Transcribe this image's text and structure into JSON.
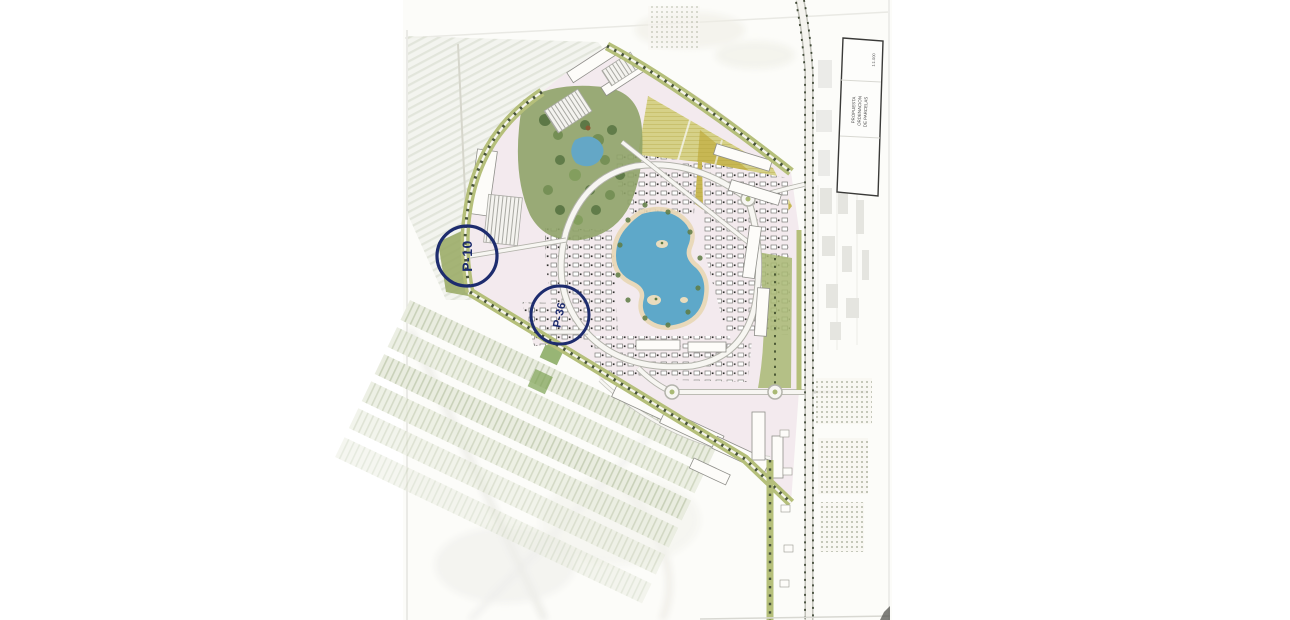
{
  "paper": {
    "tone": "#fcfcf9"
  },
  "annotations": {
    "color": "#1d2c6e",
    "circles": [
      {
        "label": "P-10"
      },
      {
        "label": "P-36"
      }
    ]
  },
  "title_block": {
    "line1": "PROPUESTA",
    "line2": "ORDENACION",
    "line3": "DE PARCELAS",
    "scale": "1:1.000"
  },
  "colors": {
    "lake": "#5ea8c9",
    "pond": "#64a7c6",
    "park_green": "#8fa368",
    "field_yellow": "#d6d188",
    "field_yellow_dark": "#c5b44e",
    "boundary_olive": "#b5bf7a",
    "development_pink": "#f3eaee"
  }
}
